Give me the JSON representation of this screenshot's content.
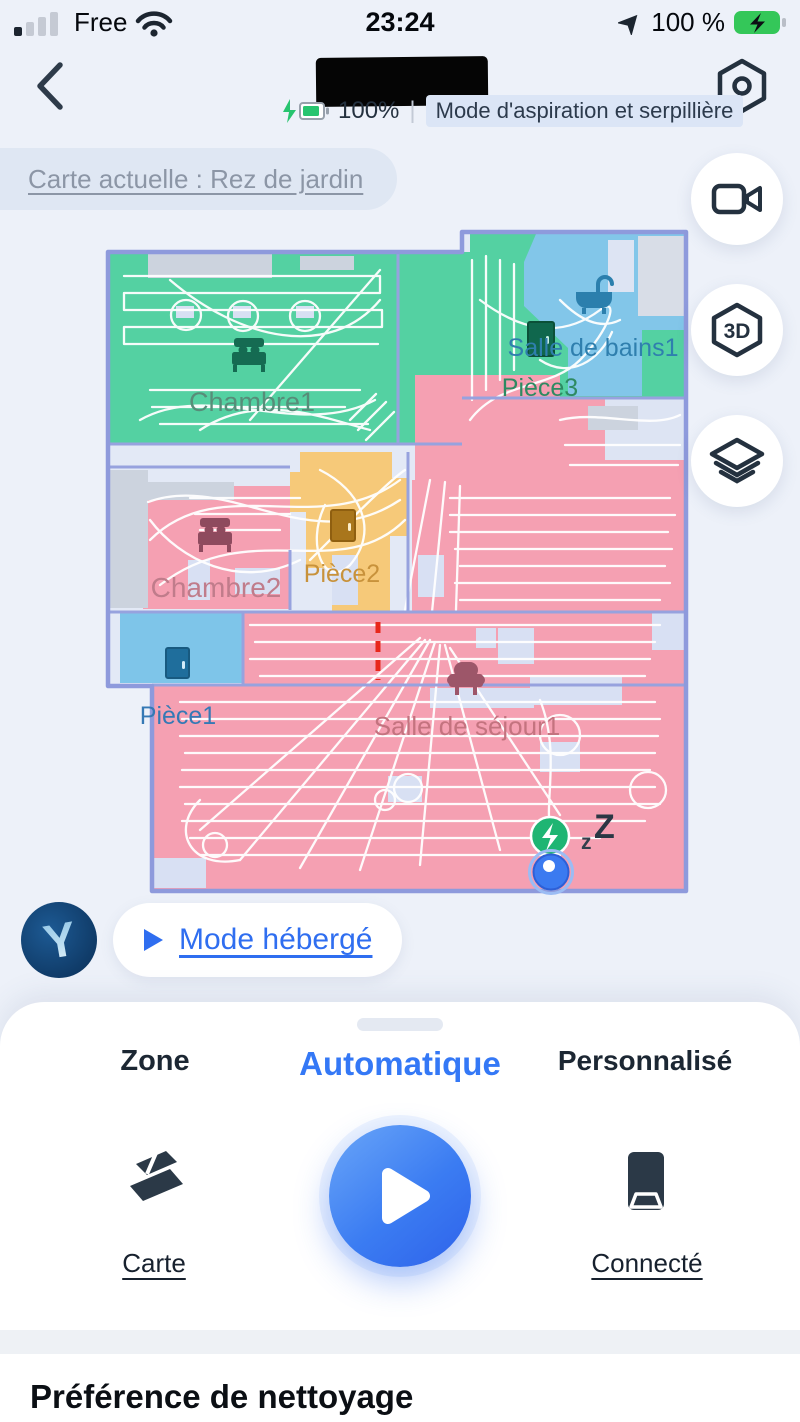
{
  "status_bar": {
    "carrier": "Free",
    "time": "23:24",
    "battery": "100 %"
  },
  "header": {
    "battery_label": "100%",
    "separator": "|",
    "mode_label": "Mode d'aspiration et serpillière"
  },
  "map_bar": {
    "label": "Carte actuelle : Rez de jardin"
  },
  "side_buttons": {
    "three_d_label": "3D"
  },
  "map": {
    "rooms": [
      {
        "label": "Chambre1",
        "color": "#54d1a2",
        "label_color": "#578d79"
      },
      {
        "label": "Pièce3",
        "color": "#54d1a2",
        "label_color": "#2e8a62"
      },
      {
        "label": "Salle de bains1",
        "color": "#82c6e9",
        "label_color": "#2f7fae"
      },
      {
        "label": "Chambre2",
        "color": "#f5a0b2",
        "label_color": "#c07c8b"
      },
      {
        "label": "Pièce2",
        "color": "#f6c979",
        "label_color": "#c8923b"
      },
      {
        "label": "Pièce1",
        "color": "#7ec5e9",
        "label_color": "#3579b5"
      },
      {
        "label": "Salle de séjour1",
        "color": "#f5a0b2",
        "label_color": "#c4737f"
      }
    ],
    "sleep_small": "z",
    "sleep_big": "Z"
  },
  "hosted_mode": {
    "label": "Mode hébergé",
    "logo_letter": "Y"
  },
  "sheet": {
    "tabs": [
      {
        "label": "Zone",
        "active": false
      },
      {
        "label": "Automatique",
        "active": true
      },
      {
        "label": "Personnalisé",
        "active": false
      }
    ],
    "map_action_label": "Carte",
    "dock_action_label": "Connecté"
  },
  "section": {
    "title": "Préférence de nettoyage"
  },
  "colors": {
    "accent_blue": "#3478f6",
    "battery_green": "#34c759",
    "dock_green": "#1fb573",
    "robot_blue": "#3b7af0",
    "virtual_wall_red": "#e8271b",
    "wall_purple": "#8e9adc"
  }
}
